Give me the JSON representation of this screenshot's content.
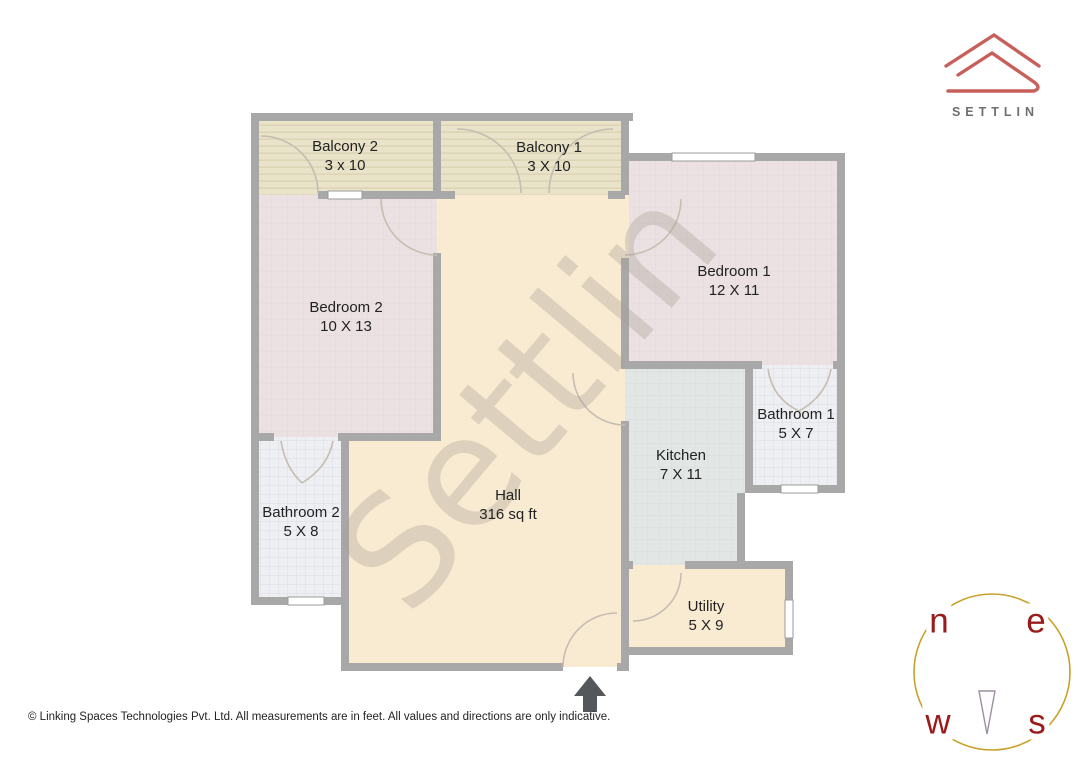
{
  "brand": {
    "logo_text": "SETTLIN"
  },
  "watermark": {
    "text": "Settlin"
  },
  "rooms": {
    "balcony2": {
      "label": "Balcony 2",
      "size": "3 x 10"
    },
    "balcony1": {
      "label": "Balcony 1",
      "size": "3 X 10"
    },
    "bedroom2": {
      "label": "Bedroom 2",
      "size": "10 X 13"
    },
    "bedroom1": {
      "label": "Bedroom 1",
      "size": "12 X 11"
    },
    "bathroom2": {
      "label": "Bathroom 2",
      "size": "5 X 8"
    },
    "bathroom1": {
      "label": "Bathroom 1",
      "size": "5 X 7"
    },
    "kitchen": {
      "label": "Kitchen",
      "size": "7 X 11"
    },
    "hall": {
      "label": "Hall",
      "size": "316 sq ft"
    },
    "utility": {
      "label": "Utility",
      "size": "5 X 9"
    }
  },
  "compass": {
    "north": "n",
    "east": "e",
    "west": "w",
    "south": "s"
  },
  "footer": {
    "copyright": "© Linking Spaces Technologies Pvt. Ltd. All measurements are in feet. All values and directions are only indicative."
  },
  "colors": {
    "logo_red": "#c75f5a",
    "wall_gray": "#a8a8a8",
    "hall_fill": "#f9ebd2",
    "bedroom_fill": "#ebe1e2",
    "balcony_fill": "#e9e3c9",
    "kitchen_fill": "#e2e6e4",
    "bathroom_fill": "#edeff2",
    "compass_ring_gold": "#c9a22b",
    "compass_letter_red": "#991b1b",
    "watermark_gray": "#a89e94"
  }
}
